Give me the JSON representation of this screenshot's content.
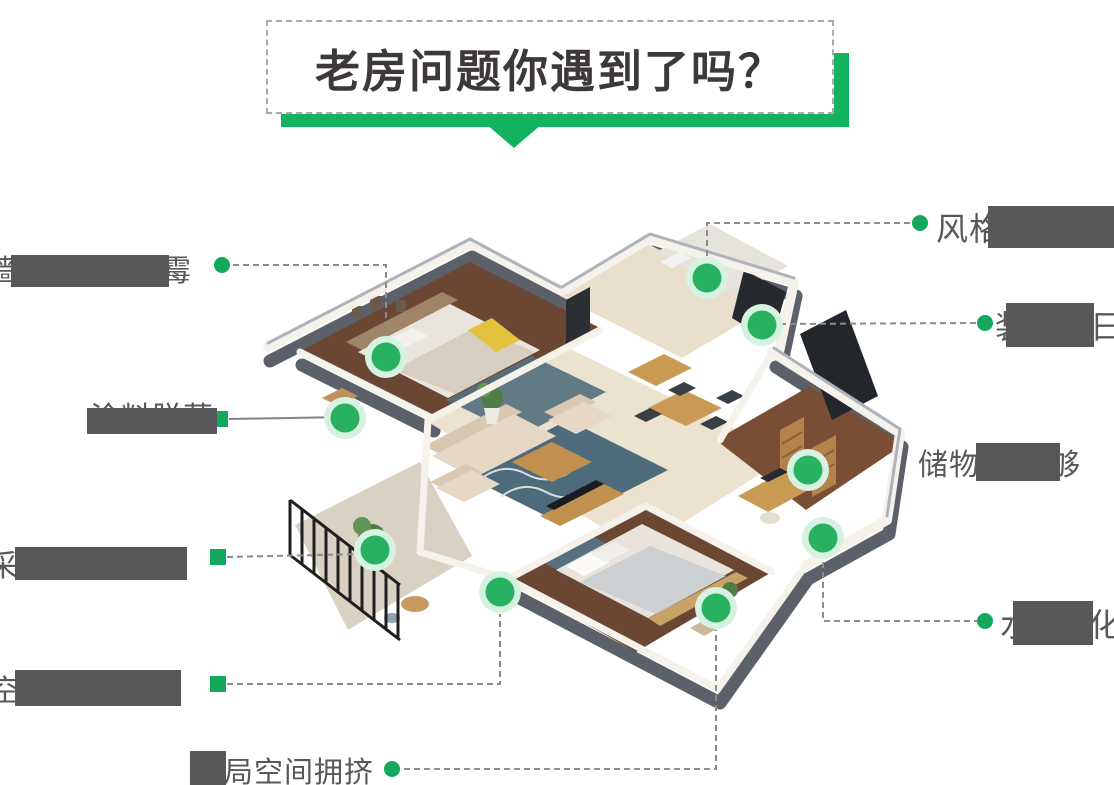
{
  "title": {
    "text": "老房问题你遇到了吗？"
  },
  "labels": {
    "style_old": {
      "before": "风格"
    },
    "decor_old": {
      "before": "装",
      "after": "日"
    },
    "storage": {
      "before": "储物",
      "after": "够"
    },
    "aging": {
      "before": "水",
      "after": "化"
    },
    "wall_mold": {
      "before": "墙",
      "after": "霉"
    },
    "paint_peel": {
      "text": "涂料脱落"
    },
    "daylight": {
      "before": "采"
    },
    "space_waste": {
      "before": "空"
    },
    "layout": {
      "text": "布局空间拥挤"
    }
  },
  "colors": {
    "banner_green": "#12b25f",
    "label_dot_green": "#14a85c",
    "marker_ring_mint": "#d6f3e2",
    "marker_inner_green": "#27b161",
    "label_text_gray": "#5a5857",
    "redaction_gray": "#58585a"
  }
}
